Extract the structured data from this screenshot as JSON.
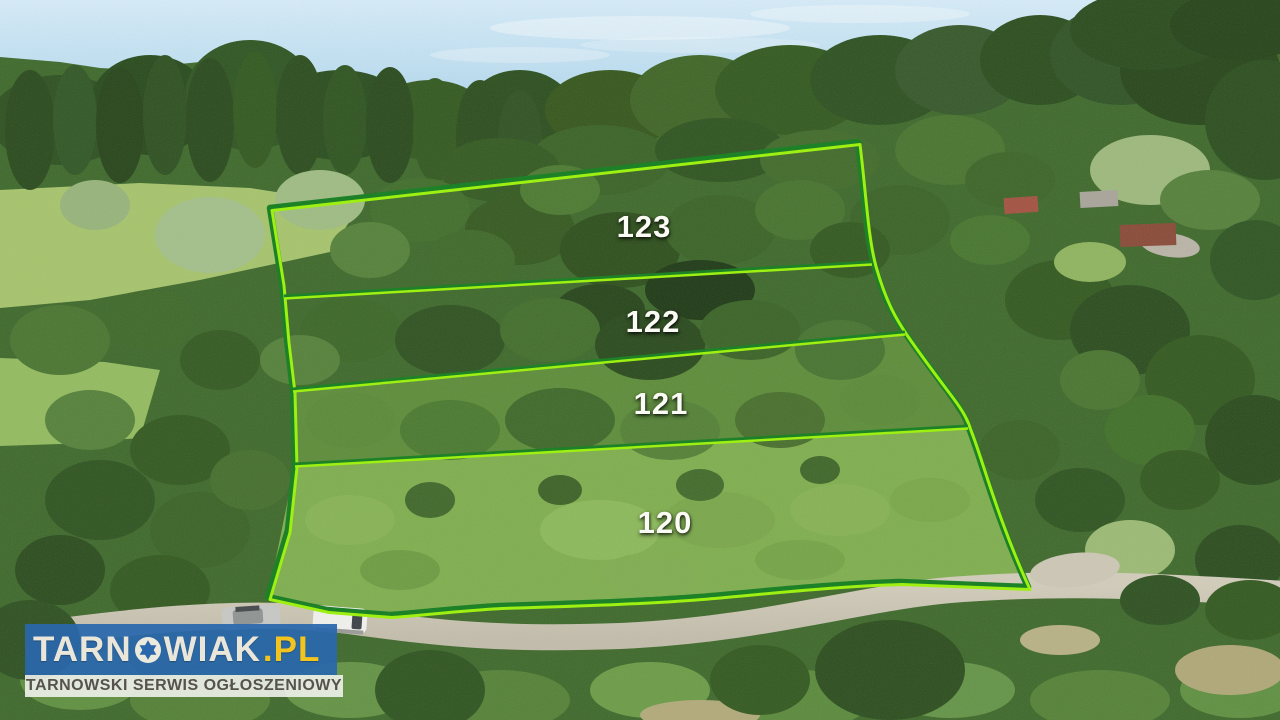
{
  "plots": [
    "123",
    "122",
    "121",
    "120"
  ],
  "boundary": {
    "highlight_green": "#9df011",
    "outline_green": "#1d8127"
  },
  "watermark": {
    "brand_prefix": "TARN",
    "brand_suffix": "WIAK",
    "brand_tld": ".PL",
    "tagline": "TARNOWSKI SERWIS OGŁOSZENIOWY",
    "colors": {
      "banner_blue": "#2a67ac",
      "tld_yellow": "#f3c41d",
      "brand_text": "#eae7da",
      "tagline_bg": "#f4f4f0",
      "tagline_text": "#55534c"
    }
  }
}
